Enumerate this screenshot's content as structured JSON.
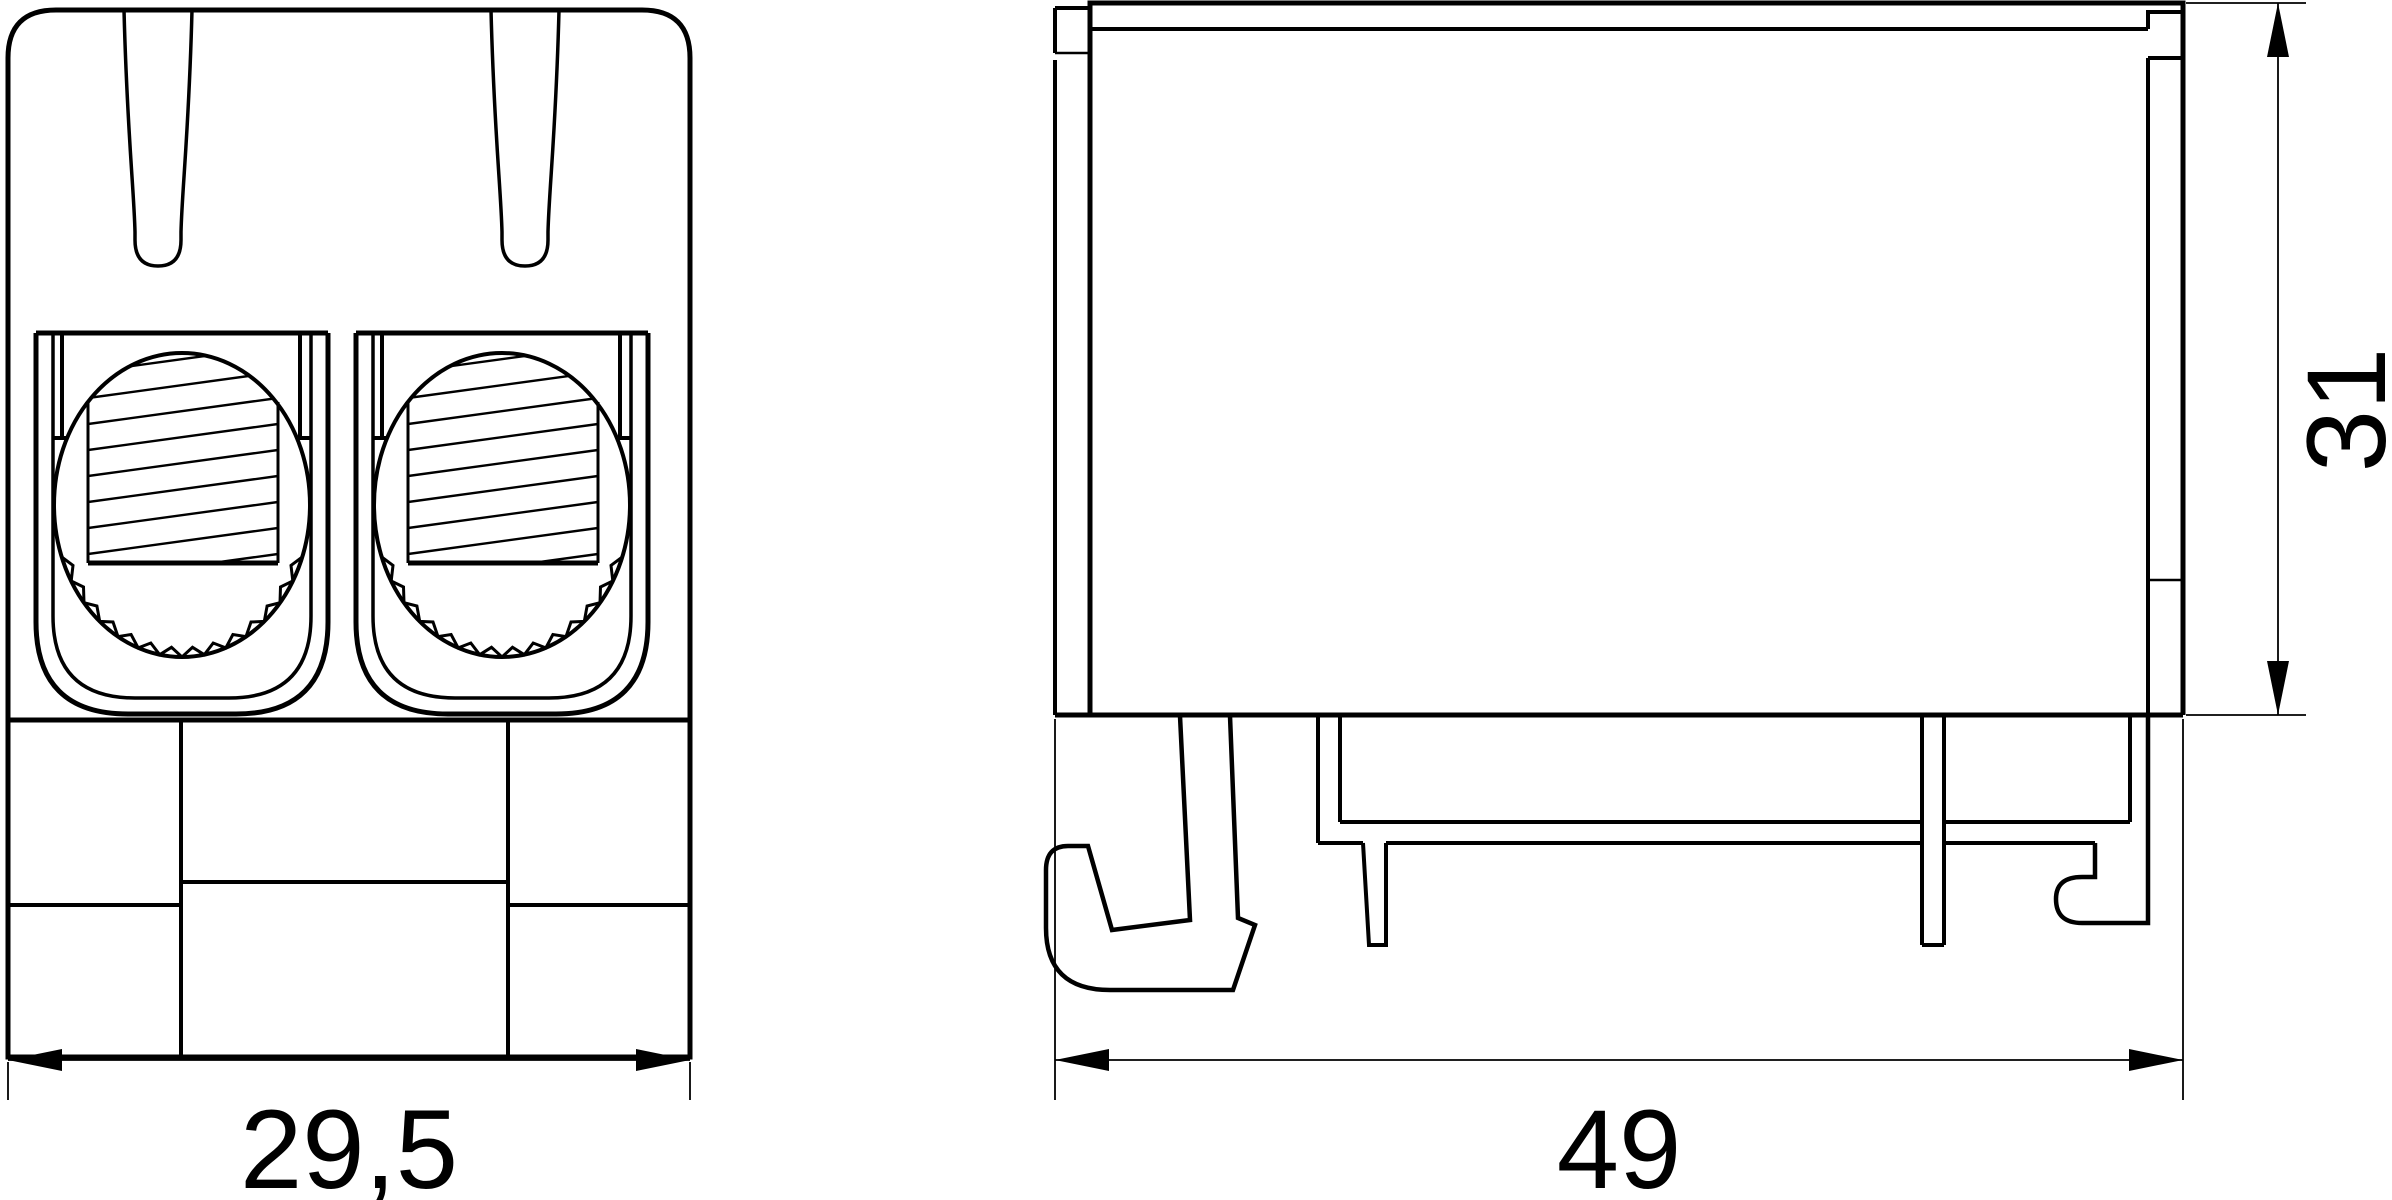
{
  "drawing": {
    "colors": {
      "background": "#ffffff",
      "line": "#000000"
    },
    "views": {
      "front": {
        "name": "terminal block front view",
        "width_dimension": "29,5"
      },
      "side": {
        "name": "terminal block side view on DIN rail",
        "width_dimension": "49",
        "height_dimension": "31"
      }
    }
  }
}
